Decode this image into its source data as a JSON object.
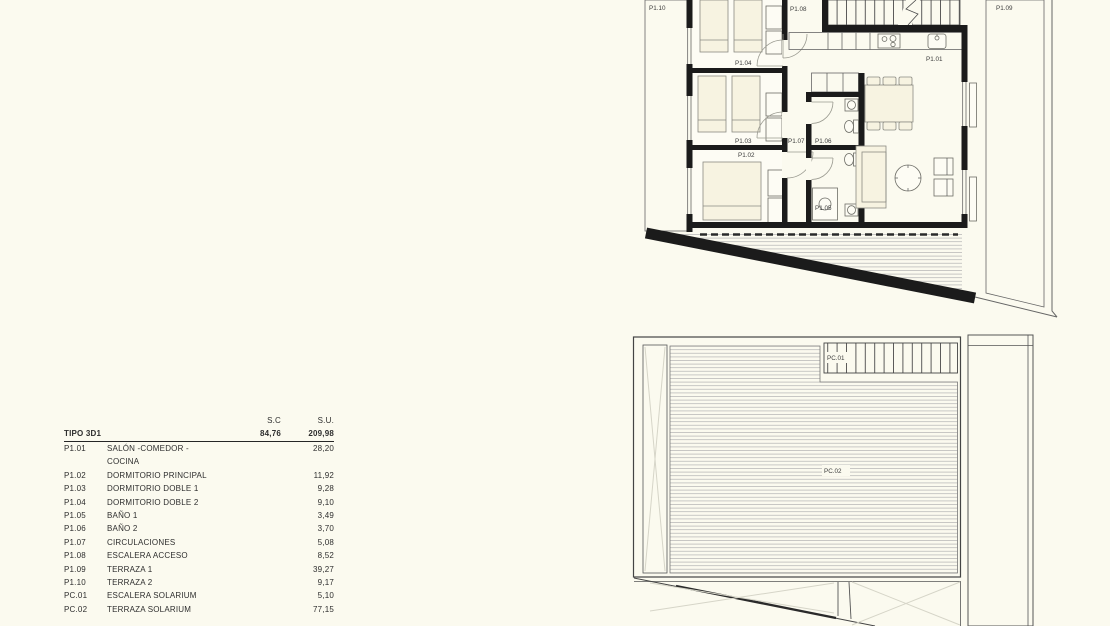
{
  "page": {
    "background": "#fbfaef"
  },
  "drawing": {
    "colors": {
      "wall": "#1b1b1b",
      "thin_line": "#666666",
      "hatch_line": "#b2b2b2",
      "furniture_fill": "#f7f3e1",
      "paper": "#fbfaef",
      "label_text": "#3d3d3d"
    },
    "upper": {
      "title": "first floor plan",
      "labels": {
        "p110": "P1.10",
        "p108": "P1.08",
        "p109": "P1.09",
        "p104": "P1.04",
        "p101": "P1.01",
        "p103": "P1.03",
        "p107": "P1.07",
        "p106": "P1.06",
        "p102": "P1.02",
        "p105": "P1.05"
      }
    },
    "solarium": {
      "title": "solarium plan",
      "labels": {
        "pc01": "PC.01",
        "pc02": "PC.02"
      }
    }
  },
  "area_table": {
    "headers": {
      "sc": "S.C",
      "su": "S.U."
    },
    "type_row": {
      "label": "TIPO 3D1",
      "sc": "84,76",
      "su": "209,98"
    },
    "rows": [
      {
        "code": "P1.01",
        "name": "SALÓN -COMEDOR - COCINA",
        "su": "28,20"
      },
      {
        "code": "P1.02",
        "name": "DORMITORIO PRINCIPAL",
        "su": "11,92"
      },
      {
        "code": "P1.03",
        "name": "DORMITORIO DOBLE 1",
        "su": "9,28"
      },
      {
        "code": "P1.04",
        "name": "DORMITORIO DOBLE 2",
        "su": "9,10"
      },
      {
        "code": "P1.05",
        "name": "BAÑO 1",
        "su": "3,49"
      },
      {
        "code": "P1.06",
        "name": "BAÑO 2",
        "su": "3,70"
      },
      {
        "code": "P1.07",
        "name": "CIRCULACIONES",
        "su": "5,08"
      },
      {
        "code": "P1.08",
        "name": "ESCALERA ACCESO",
        "su": "8,52"
      },
      {
        "code": "P1.09",
        "name": "TERRAZA 1",
        "su": "39,27"
      },
      {
        "code": "P1.10",
        "name": "TERRAZA 2",
        "su": "9,17"
      },
      {
        "code": "PC.01",
        "name": "ESCALERA SOLARIUM",
        "su": "5,10"
      },
      {
        "code": "PC.02",
        "name": "TERRAZA SOLARIUM",
        "su": "77,15"
      }
    ]
  }
}
